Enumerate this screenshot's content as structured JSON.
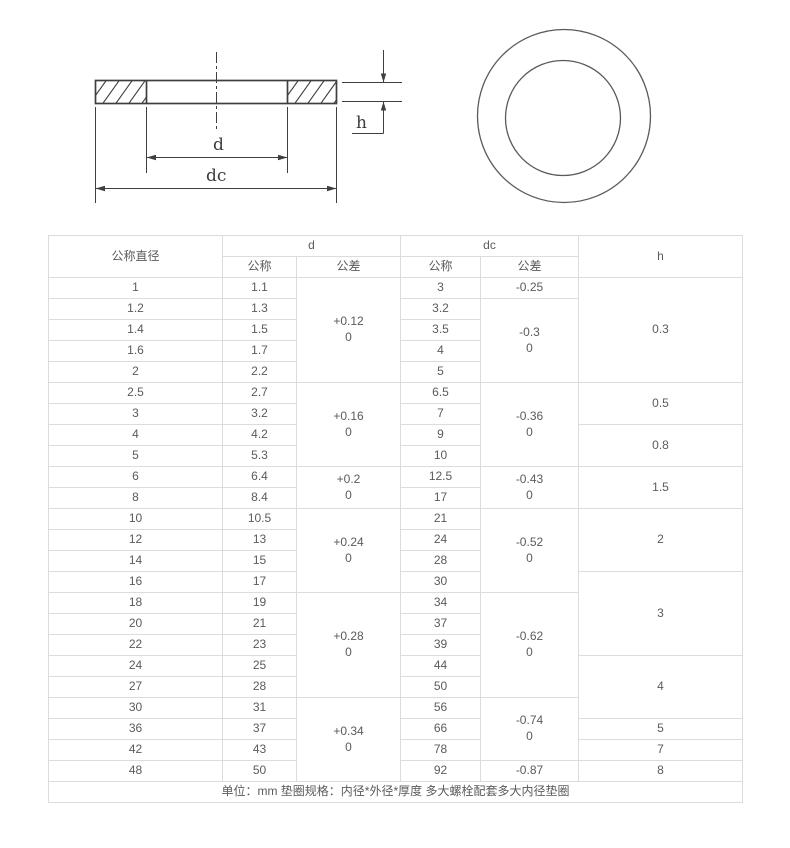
{
  "drawing": {
    "labels": {
      "inner_diameter": "d",
      "outer_diameter": "dc",
      "thickness": "h"
    }
  },
  "table": {
    "header_rows": [
      [
        {
          "t": "公称直径",
          "rs": 2
        },
        {
          "t": "d",
          "cs": 2
        },
        {
          "t": "dc",
          "cs": 2
        },
        {
          "t": "h",
          "rs": 2
        }
      ],
      [
        {
          "t": "公称"
        },
        {
          "t": "公差"
        },
        {
          "t": "公称"
        },
        {
          "t": "公差"
        }
      ]
    ],
    "body_rows": [
      [
        {
          "t": "1"
        },
        {
          "t": "1.1"
        },
        {
          "t": "+0.12\n0",
          "rs": 5
        },
        {
          "t": "3"
        },
        {
          "t": "-0.25"
        },
        {
          "t": "0.3",
          "rs": 5
        }
      ],
      [
        {
          "t": "1.2"
        },
        {
          "t": "1.3"
        },
        {
          "t": "3.2"
        },
        {
          "t": "-0.3\n0",
          "rs": 4
        }
      ],
      [
        {
          "t": "1.4"
        },
        {
          "t": "1.5"
        },
        {
          "t": "3.5"
        }
      ],
      [
        {
          "t": "1.6"
        },
        {
          "t": "1.7"
        },
        {
          "t": "4"
        }
      ],
      [
        {
          "t": "2"
        },
        {
          "t": "2.2"
        },
        {
          "t": "5"
        }
      ],
      [
        {
          "t": "2.5"
        },
        {
          "t": "2.7"
        },
        {
          "t": "+0.16\n0",
          "rs": 4
        },
        {
          "t": "6.5"
        },
        {
          "t": "-0.36\n0",
          "rs": 4
        },
        {
          "t": "0.5",
          "rs": 2
        }
      ],
      [
        {
          "t": "3"
        },
        {
          "t": "3.2"
        },
        {
          "t": "7"
        }
      ],
      [
        {
          "t": "4"
        },
        {
          "t": "4.2"
        },
        {
          "t": "9"
        },
        {
          "t": "0.8",
          "rs": 2
        }
      ],
      [
        {
          "t": "5"
        },
        {
          "t": "5.3"
        },
        {
          "t": "10"
        }
      ],
      [
        {
          "t": "6"
        },
        {
          "t": "6.4"
        },
        {
          "t": "+0.2\n0",
          "rs": 2
        },
        {
          "t": "12.5"
        },
        {
          "t": "-0.43\n0",
          "rs": 2
        },
        {
          "t": "1.5",
          "rs": 2
        }
      ],
      [
        {
          "t": "8"
        },
        {
          "t": "8.4"
        },
        {
          "t": "17"
        }
      ],
      [
        {
          "t": "10"
        },
        {
          "t": "10.5"
        },
        {
          "t": "+0.24\n0",
          "rs": 4
        },
        {
          "t": "21"
        },
        {
          "t": "-0.52\n0",
          "rs": 4
        },
        {
          "t": "2",
          "rs": 3
        }
      ],
      [
        {
          "t": "12"
        },
        {
          "t": "13"
        },
        {
          "t": "24"
        }
      ],
      [
        {
          "t": "14"
        },
        {
          "t": "15"
        },
        {
          "t": "28"
        }
      ],
      [
        {
          "t": "16"
        },
        {
          "t": "17"
        },
        {
          "t": "30"
        },
        {
          "t": "3",
          "rs": 4
        }
      ],
      [
        {
          "t": "18"
        },
        {
          "t": "19"
        },
        {
          "t": "+0.28\n0",
          "rs": 5
        },
        {
          "t": "34"
        },
        {
          "t": "-0.62\n0",
          "rs": 5
        }
      ],
      [
        {
          "t": "20"
        },
        {
          "t": "21"
        },
        {
          "t": "37"
        }
      ],
      [
        {
          "t": "22"
        },
        {
          "t": "23"
        },
        {
          "t": "39"
        }
      ],
      [
        {
          "t": "24"
        },
        {
          "t": "25"
        },
        {
          "t": "44"
        },
        {
          "t": "4",
          "rs": 3
        }
      ],
      [
        {
          "t": "27"
        },
        {
          "t": "28"
        },
        {
          "t": "50"
        }
      ],
      [
        {
          "t": "30"
        },
        {
          "t": "31"
        },
        {
          "t": "+0.34\n0",
          "rs": 4
        },
        {
          "t": "56"
        },
        {
          "t": "-0.74\n0",
          "rs": 3
        }
      ],
      [
        {
          "t": "36"
        },
        {
          "t": "37"
        },
        {
          "t": "66"
        },
        {
          "t": "5"
        }
      ],
      [
        {
          "t": "42"
        },
        {
          "t": "43"
        },
        {
          "t": "78"
        },
        {
          "t": "7"
        }
      ],
      [
        {
          "t": "48"
        },
        {
          "t": "50"
        },
        {
          "t": "92"
        },
        {
          "t": "-0.87"
        },
        {
          "t": "8"
        }
      ]
    ],
    "footer_rows": [
      [
        {
          "t": "单位：mm 垫圈规格：内径*外径*厚度 多大螺栓配套多大内径垫圈",
          "cs": 6
        }
      ]
    ],
    "column_widths": [
      174,
      74,
      104,
      80,
      98,
      164
    ]
  },
  "colors": {
    "table_border": "#dcdcdc",
    "table_text": "#5b5b5b",
    "drawing_line": "#3f3f3f"
  }
}
